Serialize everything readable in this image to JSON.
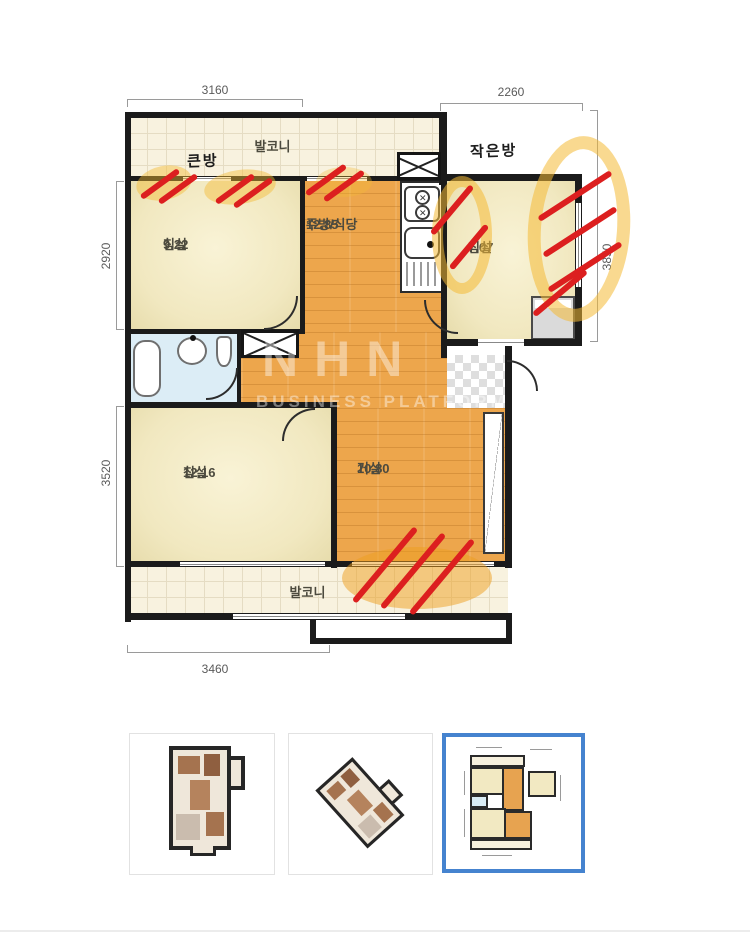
{
  "plan": {
    "balcony_top_label": "발코니",
    "balcony_bottom_label": "발코니",
    "annotations": {
      "big_room": "큰방",
      "small_room": "작은방"
    },
    "rooms": {
      "bedroom1": {
        "name": "침실",
        "area": "9.22"
      },
      "kitchen": {
        "name": "주방/식당",
        "area": "12.85"
      },
      "bedroom_small": {
        "name": "침실",
        "area": "7.07"
      },
      "bedroom2": {
        "name": "침실",
        "area": "12.16"
      },
      "living": {
        "name": "거실",
        "area": "10.80"
      }
    },
    "dimensions": {
      "top_left": "3160",
      "top_right": "2260",
      "left_upper": "2920",
      "left_lower": "3520",
      "right_side": "3850",
      "bottom": "3460"
    },
    "watermark": {
      "line1": "NHN",
      "line2": "BUSINESS PLATFORM"
    }
  },
  "colors": {
    "wall": "#1b1b1b",
    "room_cream": "#f1e8c0",
    "wood_floor": "#eda64c",
    "balcony_tile": "#f8f2df",
    "bathroom_blue": "#dcedf6",
    "highlight_yellow": "#f4ba34",
    "mark_red": "#dc1f1f",
    "selected_thumb_border": "#4583cf"
  },
  "thumbnails": {
    "items": [
      {
        "name": "3d-top-view-plan",
        "selected": false
      },
      {
        "name": "3d-isometric-plan",
        "selected": false
      },
      {
        "name": "2d-floor-plan",
        "selected": true
      }
    ]
  }
}
